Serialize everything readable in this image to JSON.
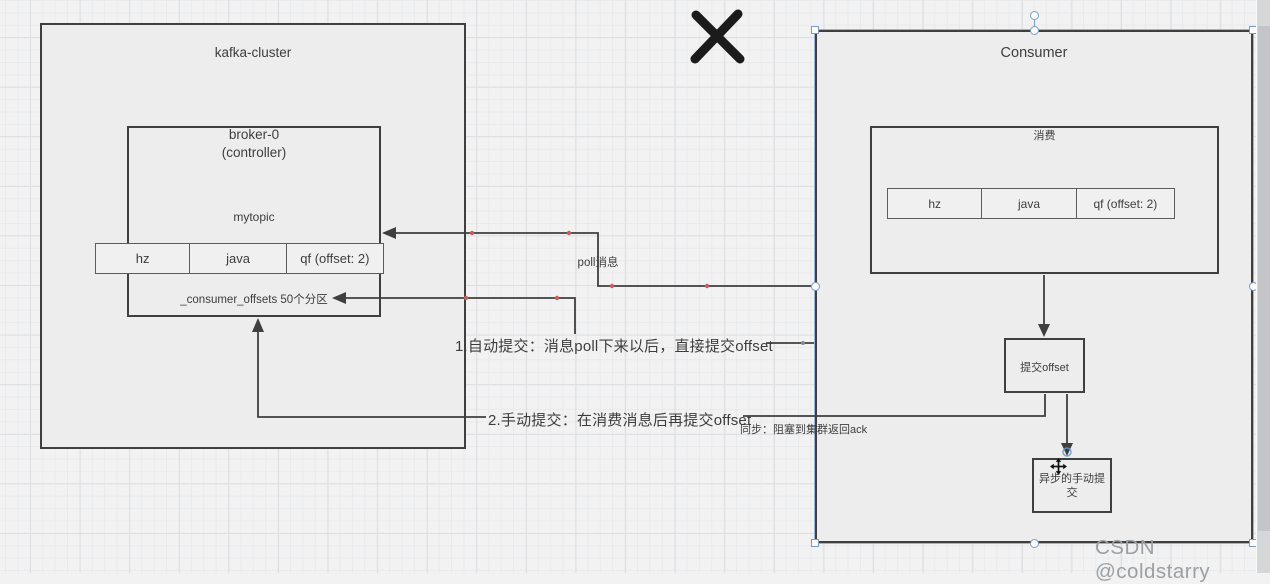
{
  "colors": {
    "line-color": "#3f3f3f",
    "box-border": "#3f3f3f",
    "box-fill": "#ededee",
    "text-color": "#3d3d3d",
    "waypoint-color": "#c65f5f",
    "handle-border": "#7a9cc6",
    "watermark-color": "#9ba0a4"
  },
  "kafka": {
    "title": "kafka-cluster",
    "broker": {
      "name": "broker-0",
      "role": "(controller)",
      "topic": "mytopic",
      "offsets_note": "_consumer_offsets 50个分区"
    },
    "partitions": [
      {
        "label": "hz"
      },
      {
        "label": "java"
      },
      {
        "label": "qf (offset: 2)"
      }
    ]
  },
  "consumer": {
    "title": "Consumer",
    "consume_label": "消费",
    "partitions": [
      {
        "label": "hz"
      },
      {
        "label": "java"
      },
      {
        "label": "qf (offset: 2)"
      }
    ],
    "commit_label": "提交offset",
    "async_label": "异步的手动提交"
  },
  "annotations": {
    "poll": "poll消息",
    "auto_commit": "1.自动提交：消息poll下来以后，直接提交offset",
    "manual_commit": "2.手动提交：在消费消息后再提交offset",
    "sync_note": "同步：阻塞到集群返回ack"
  },
  "watermark": "CSDN @coldstarry"
}
